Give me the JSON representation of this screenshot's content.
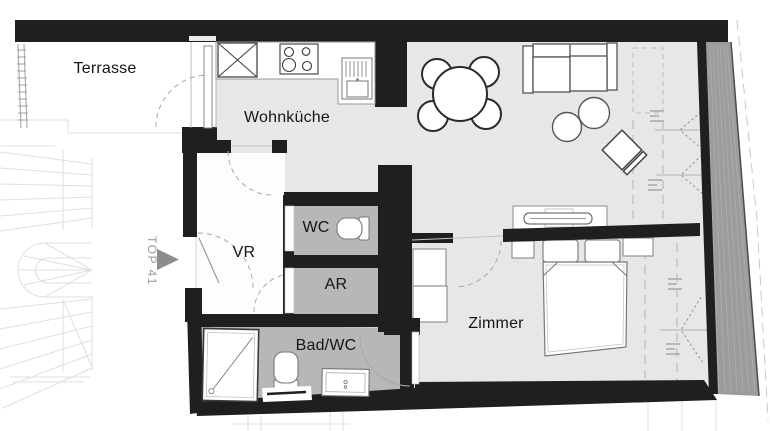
{
  "plan": {
    "unit_label": "TOP 41",
    "rooms": {
      "terrasse": "Terrasse",
      "wohnkueche": "Wohnküche",
      "wc": "WC",
      "vr": "VR",
      "ar": "AR",
      "bad_wc": "Bad/WC",
      "zimmer": "Zimmer"
    }
  },
  "colors": {
    "wall": "#1f1f1f",
    "room_floor": "#e7e7e7",
    "wet_room_floor": "#b7b7b7",
    "hall_floor": "#fdfdfd",
    "exterior_band": "#9c9c9c",
    "label_text": "#161616",
    "unit_text": "#9a9a9a",
    "background": "#ffffff"
  },
  "icons": {
    "furniture": [
      "dining-table-icon",
      "dining-chair-icon",
      "sofa-icon",
      "pouf-icon",
      "lounge-chair-icon",
      "sideboard-tv-icon",
      "double-bed-icon",
      "pillow-icon",
      "nightstand-icon",
      "wardrobe-icon",
      "tall-cabinet-icon",
      "stove-icon",
      "kitchen-sink-icon",
      "shower-icon",
      "toilet-icon",
      "washbasin-icon",
      "radiator-icon"
    ],
    "symbols": [
      "entrance-arrow-icon",
      "door-swing-arc",
      "window-opening-symbol",
      "stairwell-icon",
      "terrace-railing-icon"
    ]
  }
}
